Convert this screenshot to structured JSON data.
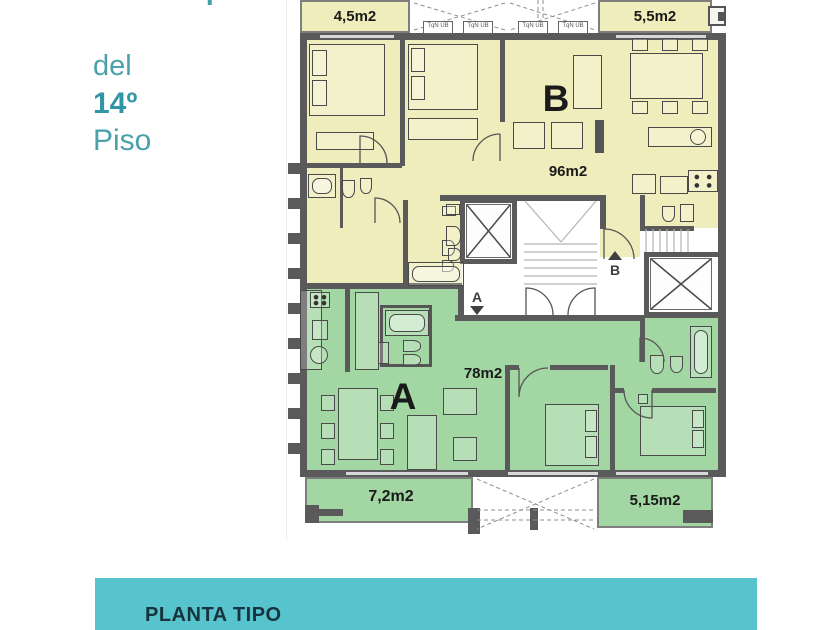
{
  "header": {
    "clipped_title": "Planta tipo",
    "line1": "del",
    "line2": "14º",
    "line3": "Piso"
  },
  "plan": {
    "balcony_top_left": "4,5m2",
    "balcony_top_right": "5,5m2",
    "balcony_bottom_left": "7,2m2",
    "balcony_bottom_right": "5,15m2",
    "apartment_b_letter": "B",
    "apartment_b_area": "96m2",
    "apartment_a_letter": "A",
    "apartment_a_area": "78m2",
    "entrance_a": "A",
    "entrance_b": "B",
    "unit_labels": [
      "TqN UB",
      "TqN UB",
      "TqN UB",
      "TqN UB"
    ]
  },
  "footer": {
    "label": "PLANTA TIPO"
  },
  "colors": {
    "teal_bar": "#56c3cd",
    "teal_text": "#45a0ac",
    "apartment_b_fill": "#efedbb",
    "apartment_a_fill": "#a2d6a3",
    "wall": "#5a5a5a"
  }
}
